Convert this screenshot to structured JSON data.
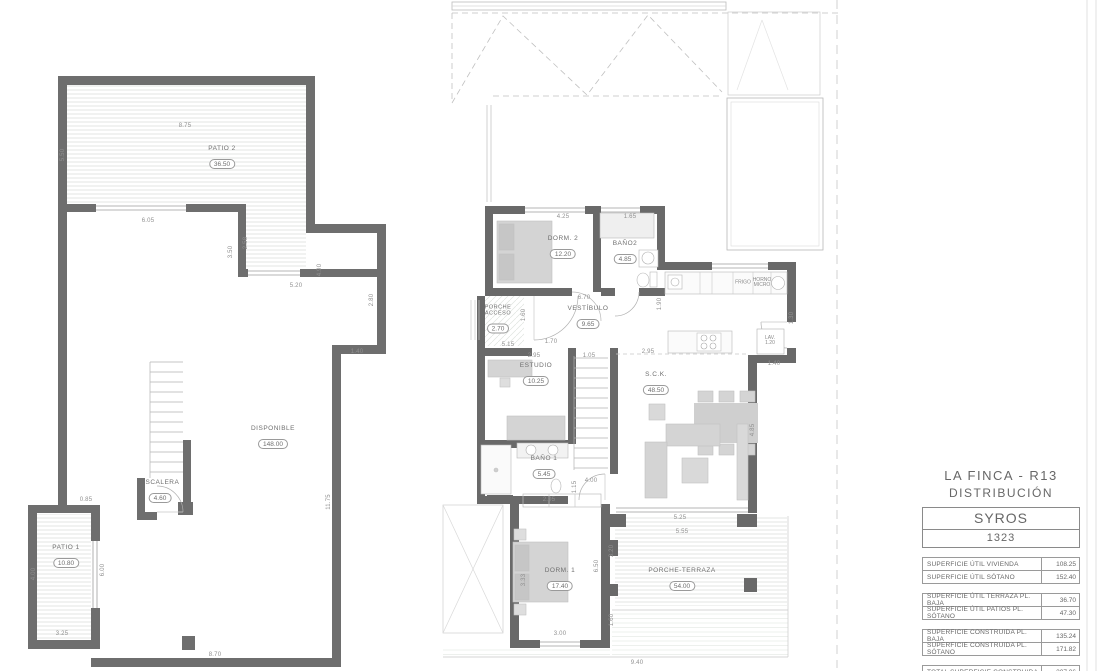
{
  "title_block": {
    "project": "LA FINCA - R13",
    "subtitle": "DISTRIBUCIÓN",
    "model": "SYROS",
    "number": "1323",
    "tables": [
      {
        "rows": [
          {
            "label": "SUPERFICIE ÚTIL VIVIENDA",
            "value": "108.25"
          },
          {
            "label": "SUPERFICIE ÚTIL SÓTANO",
            "value": "152.40"
          }
        ]
      },
      {
        "rows": [
          {
            "label": "SUPERFICIE ÚTIL TERRAZA PL. BAJA",
            "value": "36.70"
          },
          {
            "label": "SUPERFICIE ÚTIL PATIOS PL. SÓTANO",
            "value": "47.30"
          }
        ]
      },
      {
        "rows": [
          {
            "label": "SUPERFICIE CONSTRUIDA PL. BAJA",
            "value": "135.24"
          },
          {
            "label": "SUPERFICIE CONSTRUIDA PL. SÓTANO",
            "value": "171.82"
          }
        ]
      },
      {
        "rows": [
          {
            "label": "TOTAL SUPERFICIE CONSTRUIDA",
            "value": "307.06"
          }
        ]
      }
    ]
  },
  "sotano": {
    "rooms": [
      {
        "name": "PATIO 2",
        "area": "36.50"
      },
      {
        "name": "DISPONIBLE",
        "area": "148.00"
      },
      {
        "name": "ESCALERA",
        "area": "4.60"
      },
      {
        "name": "PATIO 1",
        "area": "10.80"
      }
    ],
    "dims": [
      "8.75",
      "5.50",
      "6.05",
      "3.50",
      "2.58",
      "4.90",
      "5.20",
      "1.40",
      "11.75",
      "4.00",
      "6.00",
      "0.85",
      "3.25",
      "8.70",
      "2.80"
    ]
  },
  "planta_baja": {
    "rooms": [
      {
        "name": "DORM. 2",
        "area": "12.20"
      },
      {
        "name": "BAÑO2",
        "area": "4.85"
      },
      {
        "name": "PORCHE ACCESO",
        "area": "2.70"
      },
      {
        "name": "VESTÍBULO",
        "area": "9.65"
      },
      {
        "name": "ESTUDIO",
        "area": "10.25"
      },
      {
        "name": "BAÑO 1",
        "area": "5.45"
      },
      {
        "name": "S.C.K.",
        "area": "48.50"
      },
      {
        "name": "DORM. 1",
        "area": "17.40"
      },
      {
        "name": "PORCHE-TERRAZA",
        "area": "54.00"
      }
    ],
    "fixtures": [
      "FRIGO",
      "HORNO MICRO",
      "LAV. 1.20"
    ],
    "dims": [
      "4.25",
      "1.65",
      "6.70",
      "1.60",
      "2.95",
      "1.70",
      "1.05",
      "2.95",
      "1.90",
      "1.40",
      "1.30",
      "5.15",
      "4.00",
      "1.15",
      "2.05",
      "3.33",
      "3.00",
      "5.25",
      "5.55",
      "3.20",
      "6.50",
      "1.60",
      "9.40",
      "4.85"
    ]
  }
}
